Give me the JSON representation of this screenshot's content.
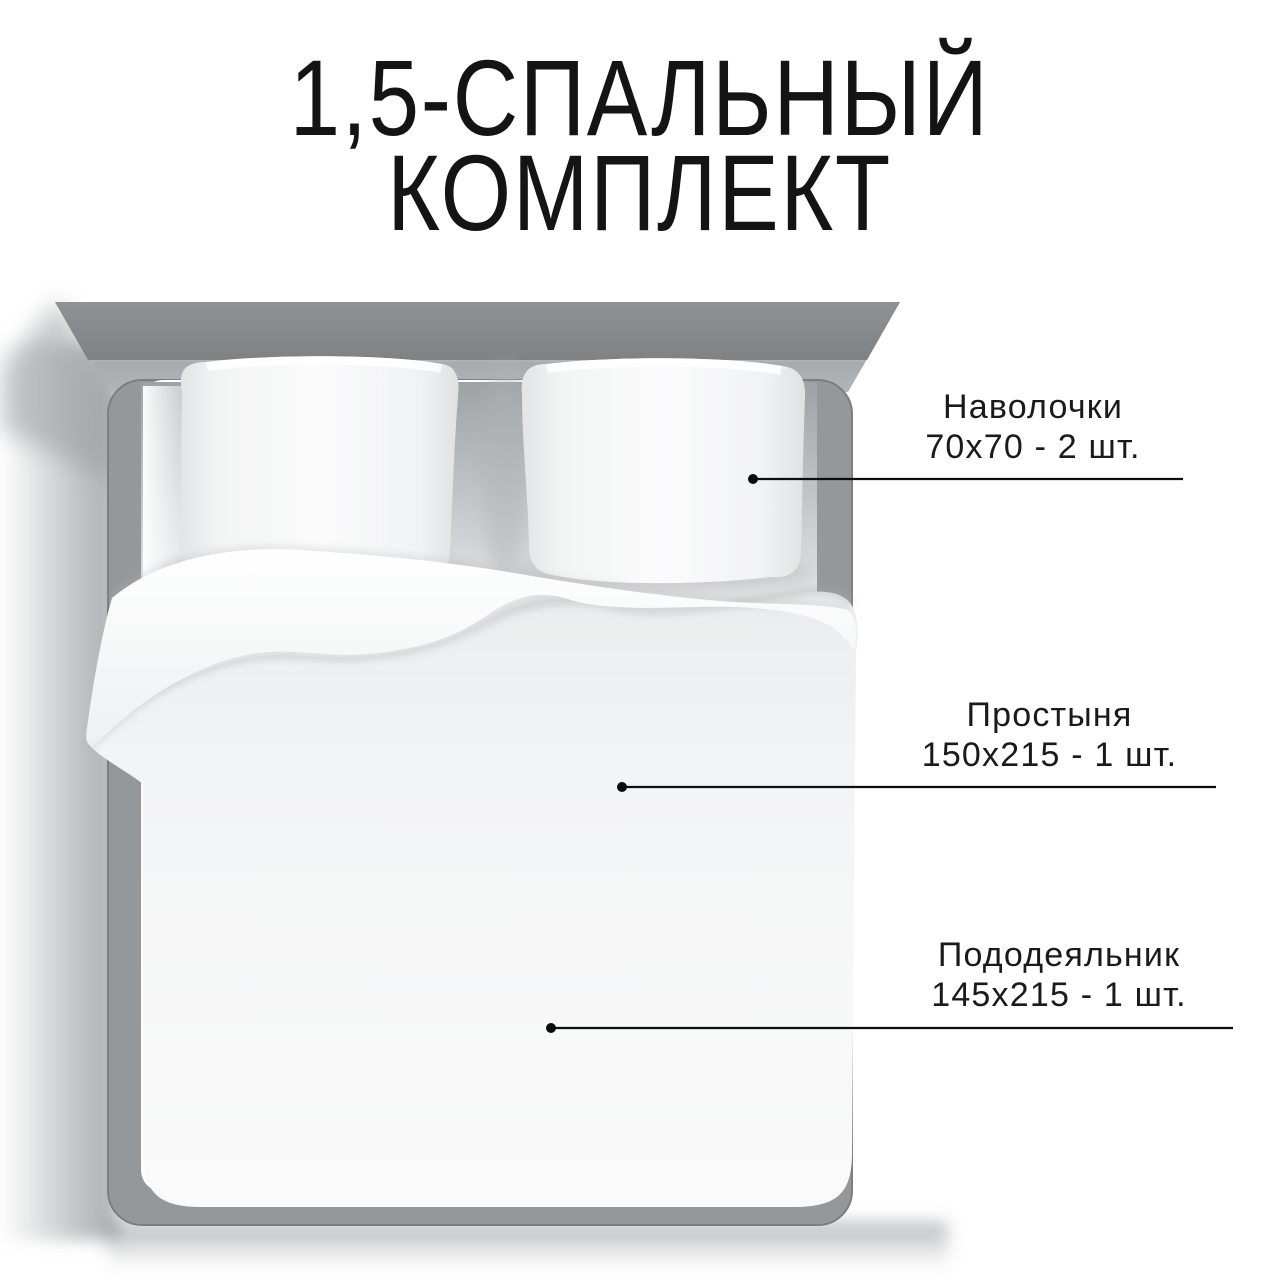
{
  "title": {
    "line1": "1,5-СПАЛЬНЫЙ",
    "line2": "КОМПЛЕКТ"
  },
  "callouts": [
    {
      "item": "Наволочки",
      "quantity": "70х70 - 2 шт."
    },
    {
      "item": "Простыня",
      "quantity": "150х215 - 1 шт."
    },
    {
      "item": "Пододеяльник",
      "quantity": "145х215 - 1 шт."
    }
  ],
  "colors": {
    "background": "#ffffff",
    "text": "#1a1a1a",
    "callout_line": "#0d0d0d",
    "headboard_top": "#85898c",
    "headboard_face": "#9fa3a6",
    "frame": "#94989b",
    "mattress": "#fdfdfd",
    "duvet": "#f3f4f5",
    "shadow": "#9a9ea1"
  }
}
